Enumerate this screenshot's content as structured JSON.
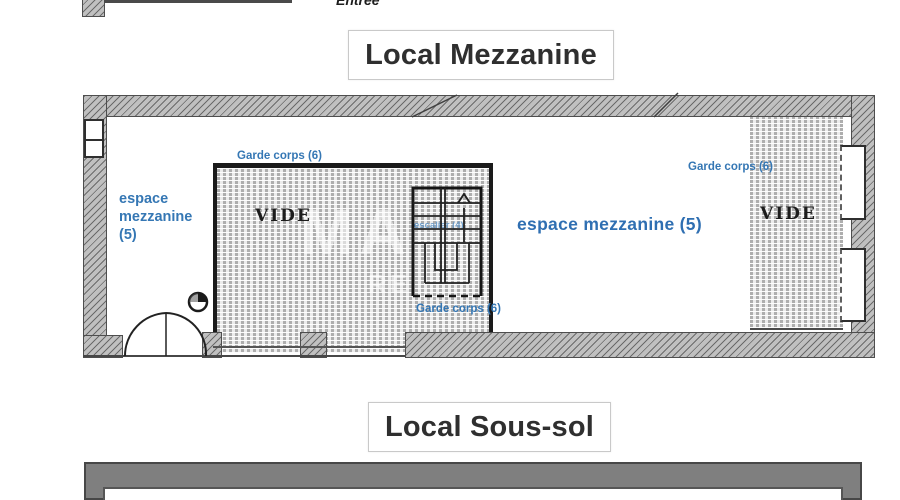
{
  "fragment_top": {
    "entree_label": "Entrée"
  },
  "titles": {
    "mezzanine": "Local Mezzanine",
    "sous_sol": "Local Sous-sol"
  },
  "plan": {
    "left_area_label_lines": [
      "espace",
      "mezzanine",
      "(5)"
    ],
    "center_area_label": "espace mezzanine (5)",
    "left_void_label": "VIDE",
    "right_void_label": "VIDE",
    "stair_label": "escalier (4)",
    "guardrail_labels": {
      "left_void_top": "Garde corps (6)",
      "stair_bottom": "Garde corps (6)",
      "right_void": "Garde corps (6)"
    }
  },
  "watermark": {
    "line1": "MA",
    "line2": "RE"
  },
  "colors": {
    "label_blue": "#3577b4",
    "title_text": "#2f2f2f",
    "wall_outline": "#4e4e4e"
  }
}
